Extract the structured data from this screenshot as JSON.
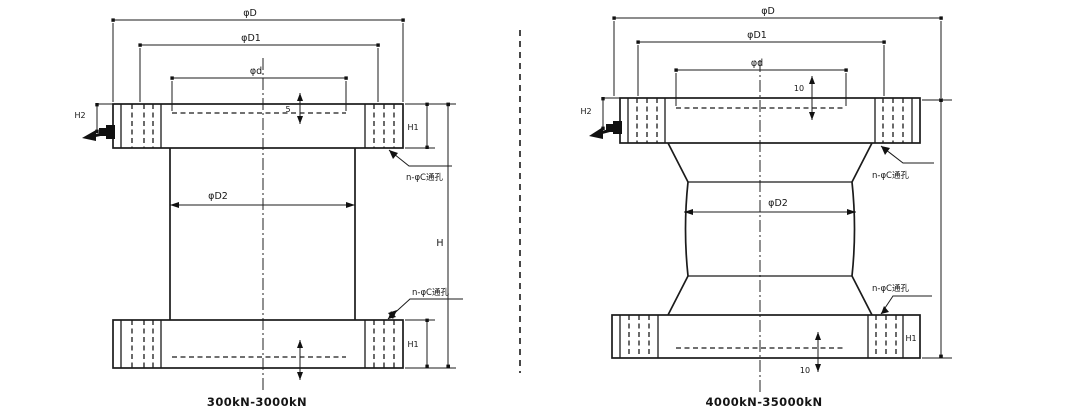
{
  "diagrams": [
    {
      "caption": "300kN-3000kN",
      "labels": {
        "outer_diameter": "φD",
        "bolt_circle_diameter": "φD1",
        "boss_diameter": "φd",
        "column_diameter": "φD2",
        "total_height": "H",
        "flange_thickness_top": "H1",
        "flange_thickness_bottom": "H1",
        "cable_height": "H2",
        "recess_depth_top": "5",
        "hole_note_top": "n-φC通孔",
        "hole_note_bottom": "n-φC通孔"
      }
    },
    {
      "caption": "4000kN-35000kN",
      "labels": {
        "outer_diameter": "φD",
        "bolt_circle_diameter": "φD1",
        "boss_diameter": "φd",
        "column_diameter": "φD2",
        "flange_thickness_bottom": "H1",
        "cable_height": "H2",
        "recess_depth_top": "10",
        "recess_depth_bottom": "10",
        "hole_note_top": "n-φC通孔",
        "hole_note_bottom": "n-φC通孔"
      }
    }
  ]
}
